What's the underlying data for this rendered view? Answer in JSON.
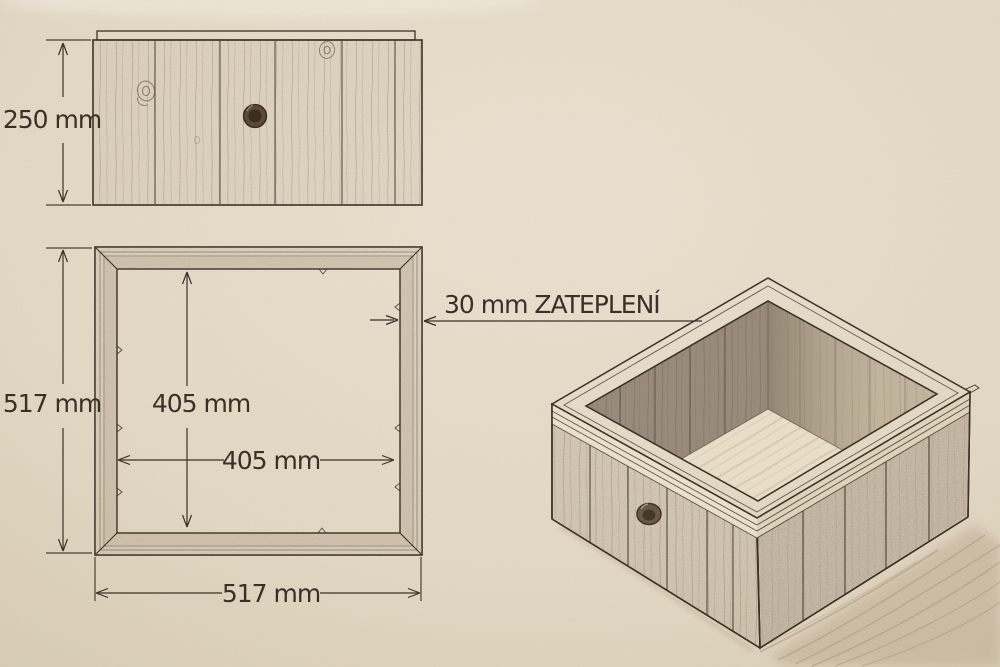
{
  "palette": {
    "paper": "#ece3d0",
    "ink": "#3c3226",
    "wood_light": "#dacdb4",
    "wood_mid": "#bcae96",
    "wood_dark": "#95897a",
    "rim_cream": "#ece3cf",
    "shadow": "#b7a688"
  },
  "front_view": {
    "height_dim": "250 mm"
  },
  "plan_view": {
    "outer_height_dim": "517 mm",
    "outer_width_dim": "517 mm",
    "inner_height_dim": "405 mm",
    "inner_width_dim": "405 mm",
    "insulation_note": "30 mm ZATEPLENÍ"
  }
}
